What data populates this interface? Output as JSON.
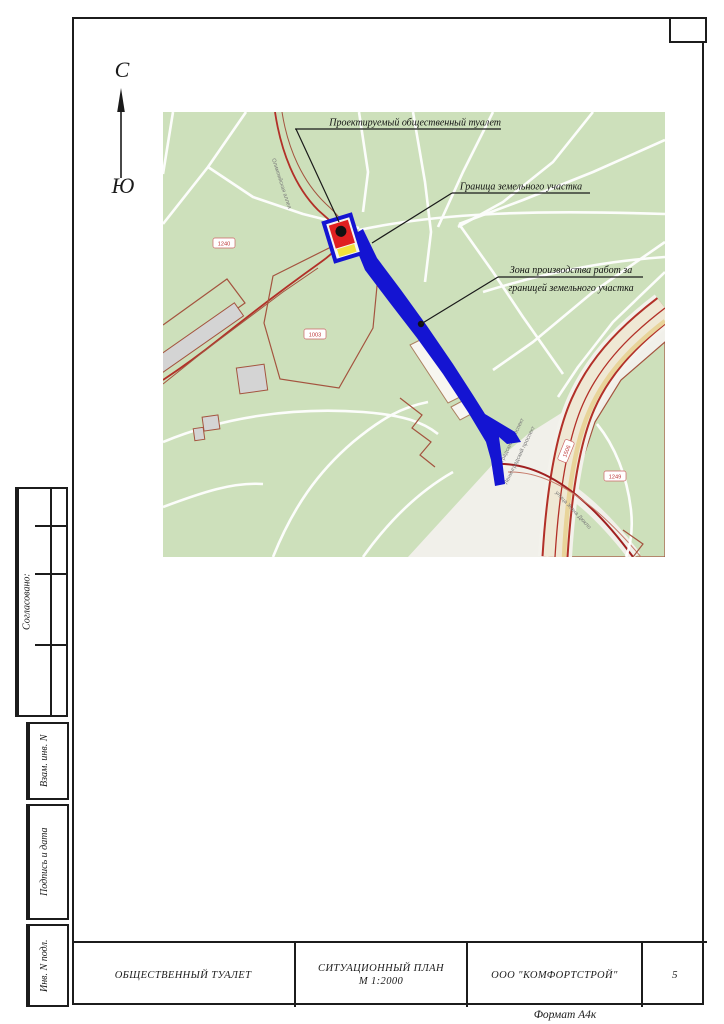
{
  "north_arrow": {
    "north": "С",
    "south": "Ю"
  },
  "map": {
    "annotations": {
      "toilet": "Проектируемый общественный туалет",
      "boundary": "Граница земельного участка",
      "work_zone_line1": "Зона производства работ за",
      "work_zone_line2": "границей земельного участка"
    },
    "street_labels": {
      "olimpiyskaya": "Олимпийская аллея",
      "leningradsky_1": "Ленинградский проспект",
      "leningradsky_2": "Ленинградский проспект",
      "zhana": "улица Жана Дюкло"
    },
    "parcel_labels": {
      "p1240": "1240",
      "p1003": "1003",
      "p1249": "1249",
      "p1506": "1506"
    }
  },
  "sidebar": {
    "agreed": "Согласовано:",
    "vzam": "Взам. инв. N",
    "podpis": "Подпись и дата",
    "inv": "Инв. N подл."
  },
  "title_block": {
    "object": "ОБЩЕСТВЕННЫЙ ТУАЛЕТ",
    "doc_title": "СИТУАЦИОННЫЙ ПЛАН",
    "scale": "М 1:2000",
    "company": "ООО \"КОМФОРТСТРОЙ\"",
    "sheet": "5",
    "format": "Формат А4к"
  },
  "colors": {
    "map_green": "#cde0bb",
    "work_zone_blue": "#1414d2",
    "marker_red": "#e02020",
    "marker_yellow": "#f2e23c",
    "road_red": "#b23028"
  }
}
